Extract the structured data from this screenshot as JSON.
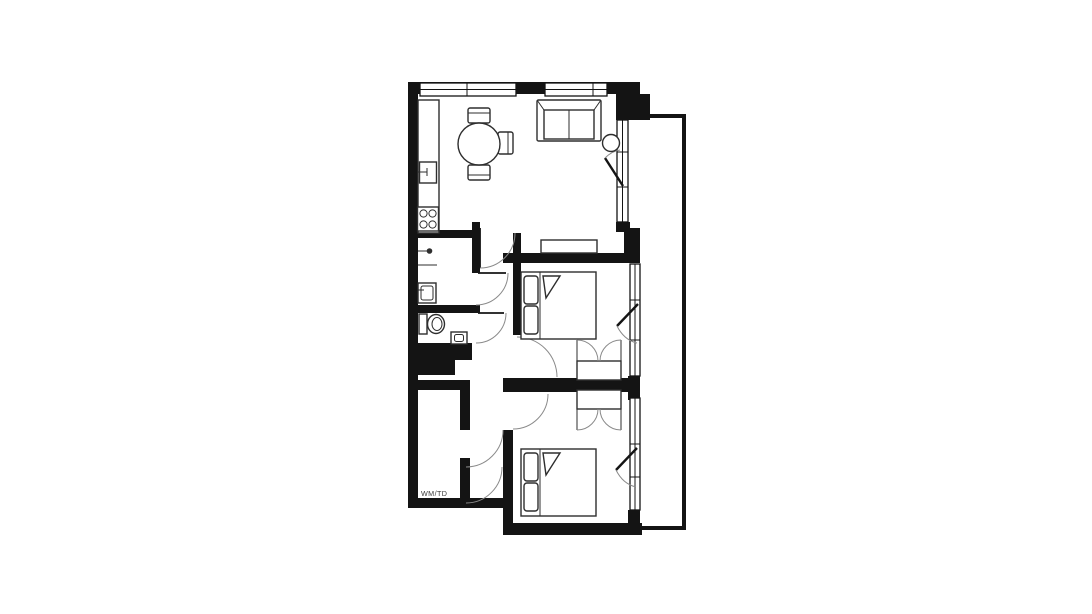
{
  "plan": {
    "labels": {
      "utility": "WM/TD"
    },
    "colors": {
      "wall": "#141414",
      "furniture_line": "#2e2e2e",
      "door_arc": "#8a8a8a",
      "background": "#ffffff"
    },
    "rooms": [
      "living-kitchen",
      "bathroom",
      "wc",
      "hallway",
      "bedroom-1",
      "bedroom-2",
      "utility",
      "balcony"
    ],
    "furniture": [
      "kitchen-counter",
      "kitchen-sink",
      "hob",
      "dining-table",
      "dining-chairs",
      "sofa",
      "side-table",
      "sideboard",
      "double-bed-1",
      "wardrobe-1",
      "double-bed-2",
      "wardrobe-2",
      "shower",
      "washbasin",
      "toilet"
    ]
  }
}
